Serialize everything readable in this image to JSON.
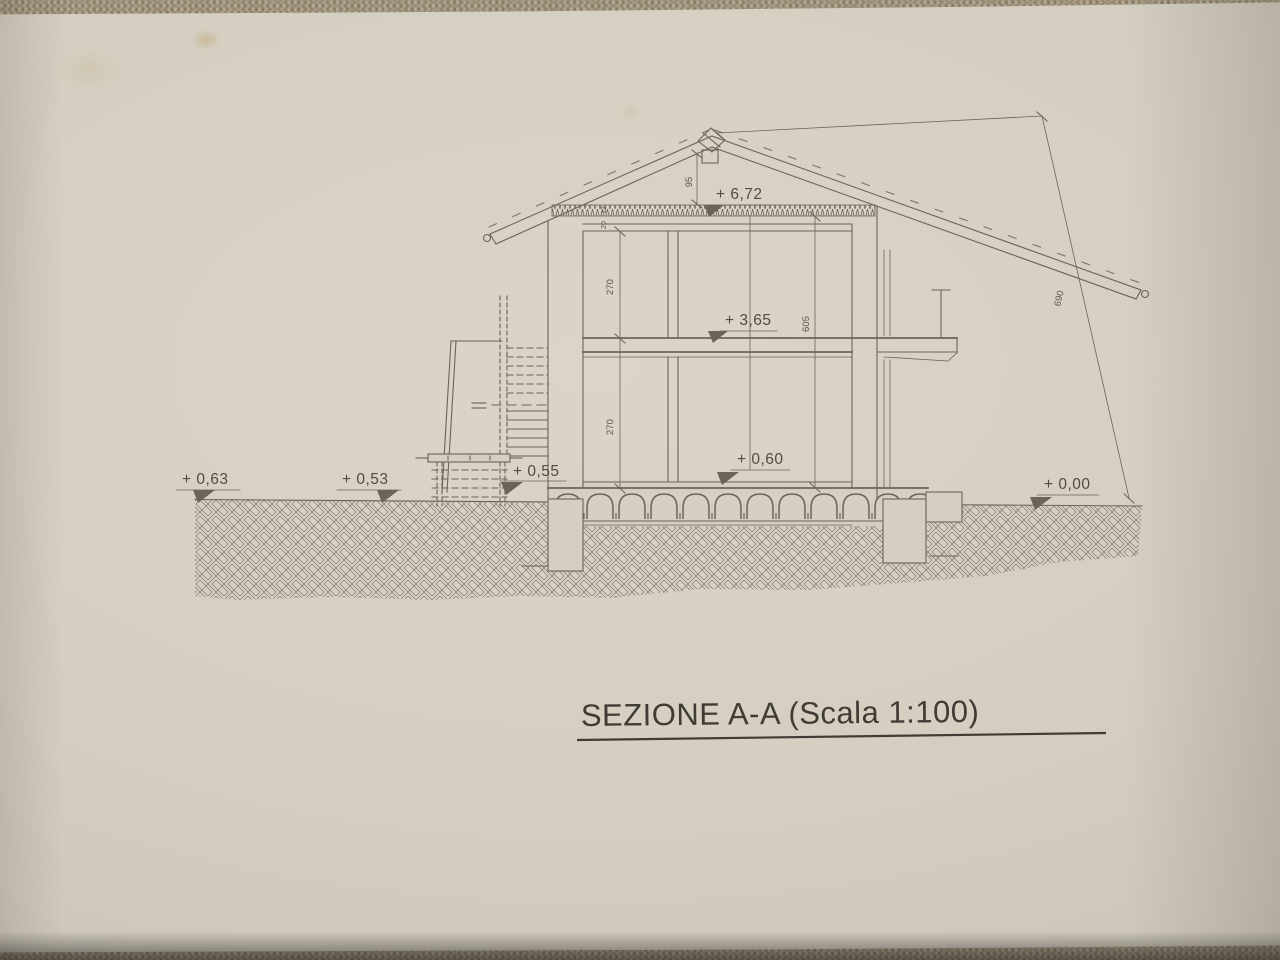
{
  "title": {
    "text": "SEZIONE A-A (Scala 1:100)"
  },
  "levels": {
    "ridge": "+ 6,72",
    "floor1": "+ 3,65",
    "floor0": "+ 0,60",
    "terrain_left": "+ 0,63",
    "terrain_mid": "+ 0,53",
    "landing": "+ 0,55",
    "terrain_right": "+ 0,00"
  },
  "dims": {
    "room_upper": "270",
    "room_lower": "270",
    "interior_total": "605",
    "ridge_rise": "95",
    "overall_height": "690",
    "layer_a": "12",
    "layer_b": "20"
  },
  "colors": {
    "paper": "#d6d0c2",
    "ink": "#6b6458",
    "fabric": "#a2967f",
    "title_ink": "#403b34"
  }
}
